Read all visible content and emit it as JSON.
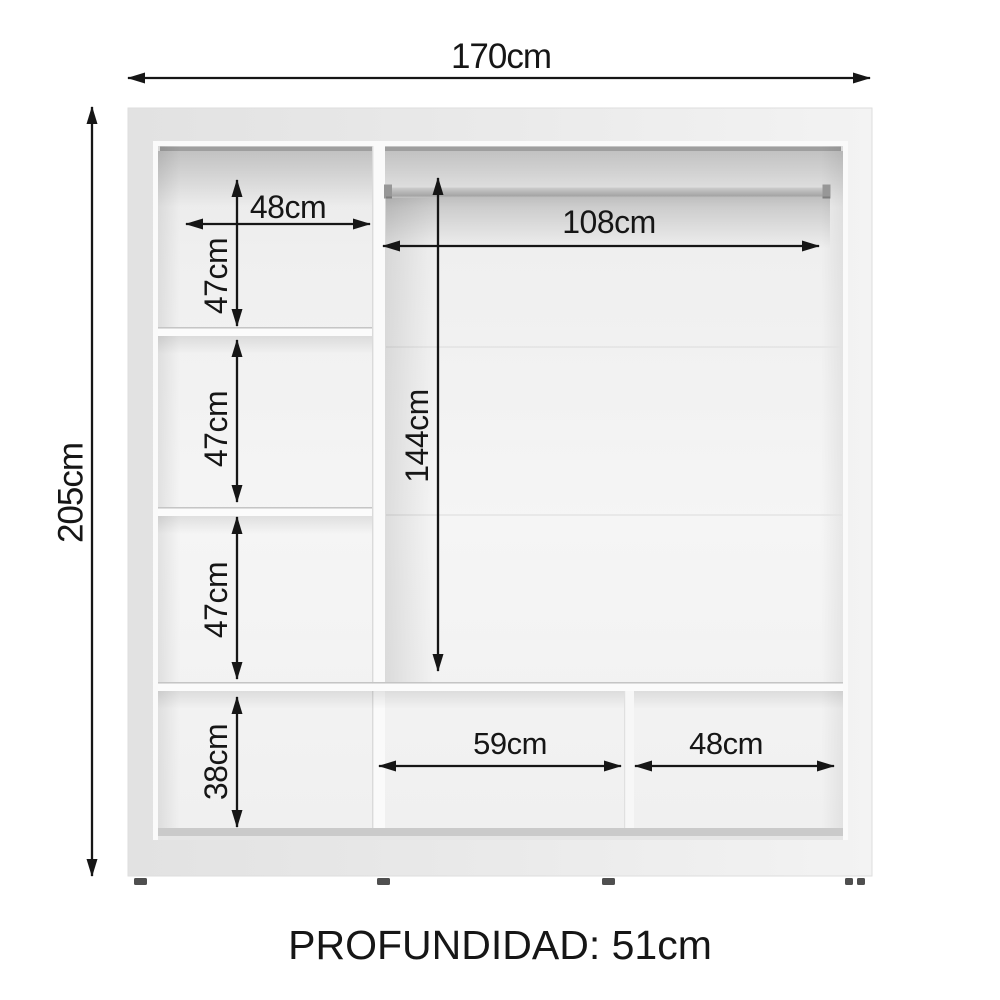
{
  "diagram": {
    "kind": "wardrobe-interior-dimension-diagram",
    "overall": {
      "width_label": "170cm",
      "height_label": "205cm",
      "depth_label": "PROFUNDIDAD: 51cm"
    },
    "interior_dimensions": {
      "top_left_shelf_width": "48cm",
      "left_cell_1_height": "47cm",
      "left_cell_2_height": "47cm",
      "left_cell_3_height": "47cm",
      "left_bottom_cell_height": "38cm",
      "hanging_section_width": "108cm",
      "hanging_section_height": "144cm",
      "bottom_center_cell_width": "59cm",
      "bottom_right_cell_width": "48cm"
    },
    "colors": {
      "line": "#161616",
      "frame_gray": "#e7e7e7",
      "interior_gray": "#f2f2f2",
      "rod_gray": "#b3b3b3",
      "feet": "#4f4f4f"
    }
  }
}
